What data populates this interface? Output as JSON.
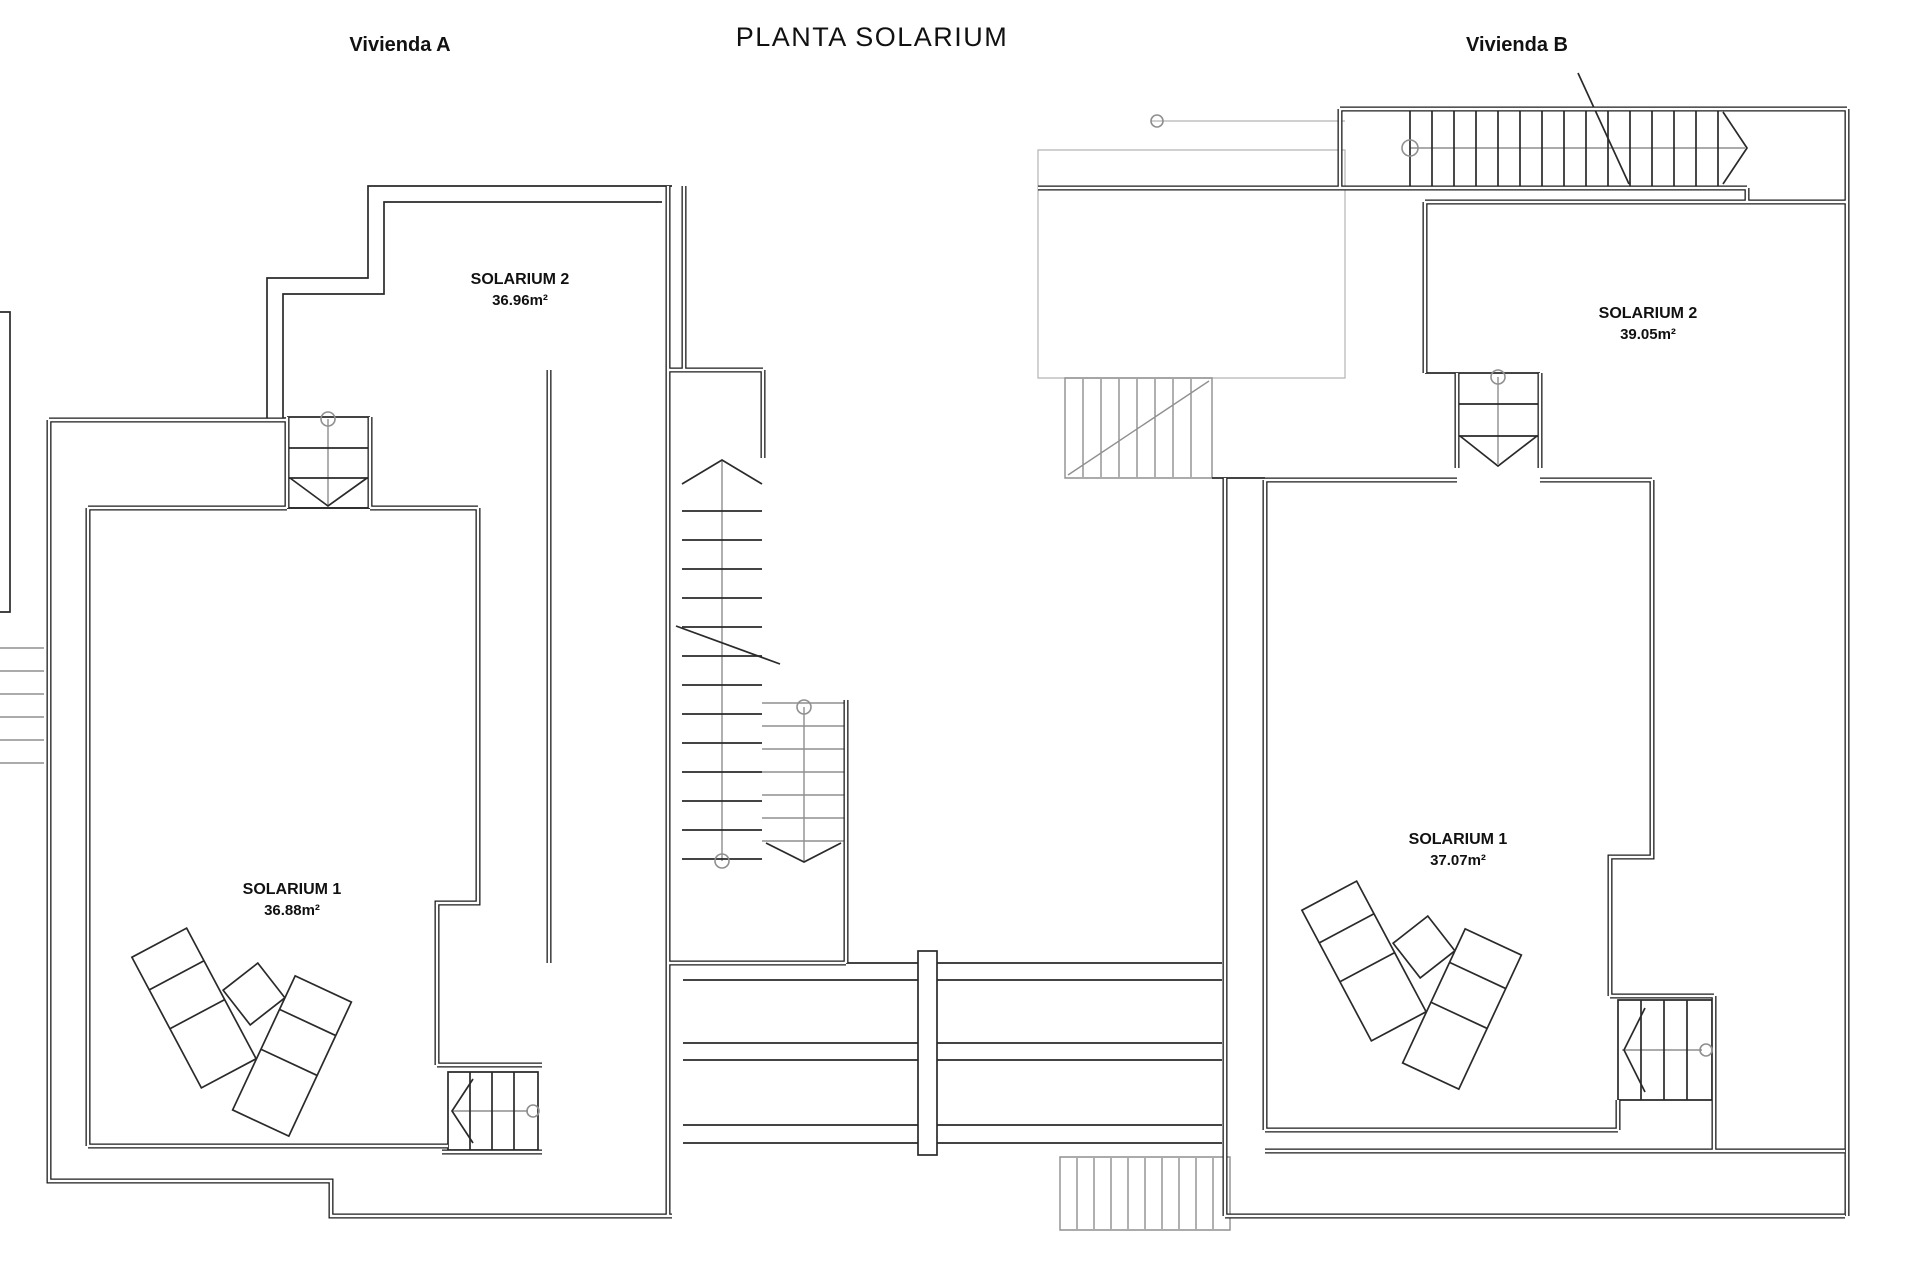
{
  "title": "PLANTA SOLARIUM",
  "units": {
    "a": {
      "name": "Vivienda A",
      "solarium2": {
        "label": "SOLARIUM 2",
        "area": "36.96m²"
      },
      "solarium1": {
        "label": "SOLARIUM 1",
        "area": "36.88m²"
      }
    },
    "b": {
      "name": "Vivienda B",
      "solarium2": {
        "label": "SOLARIUM 2",
        "area": "39.05m²"
      },
      "solarium1": {
        "label": "SOLARIUM 1",
        "area": "37.07m²"
      }
    }
  },
  "colors": {
    "line": "#1c1c1c",
    "gray": "#8f8f8f",
    "background": "#ffffff"
  }
}
